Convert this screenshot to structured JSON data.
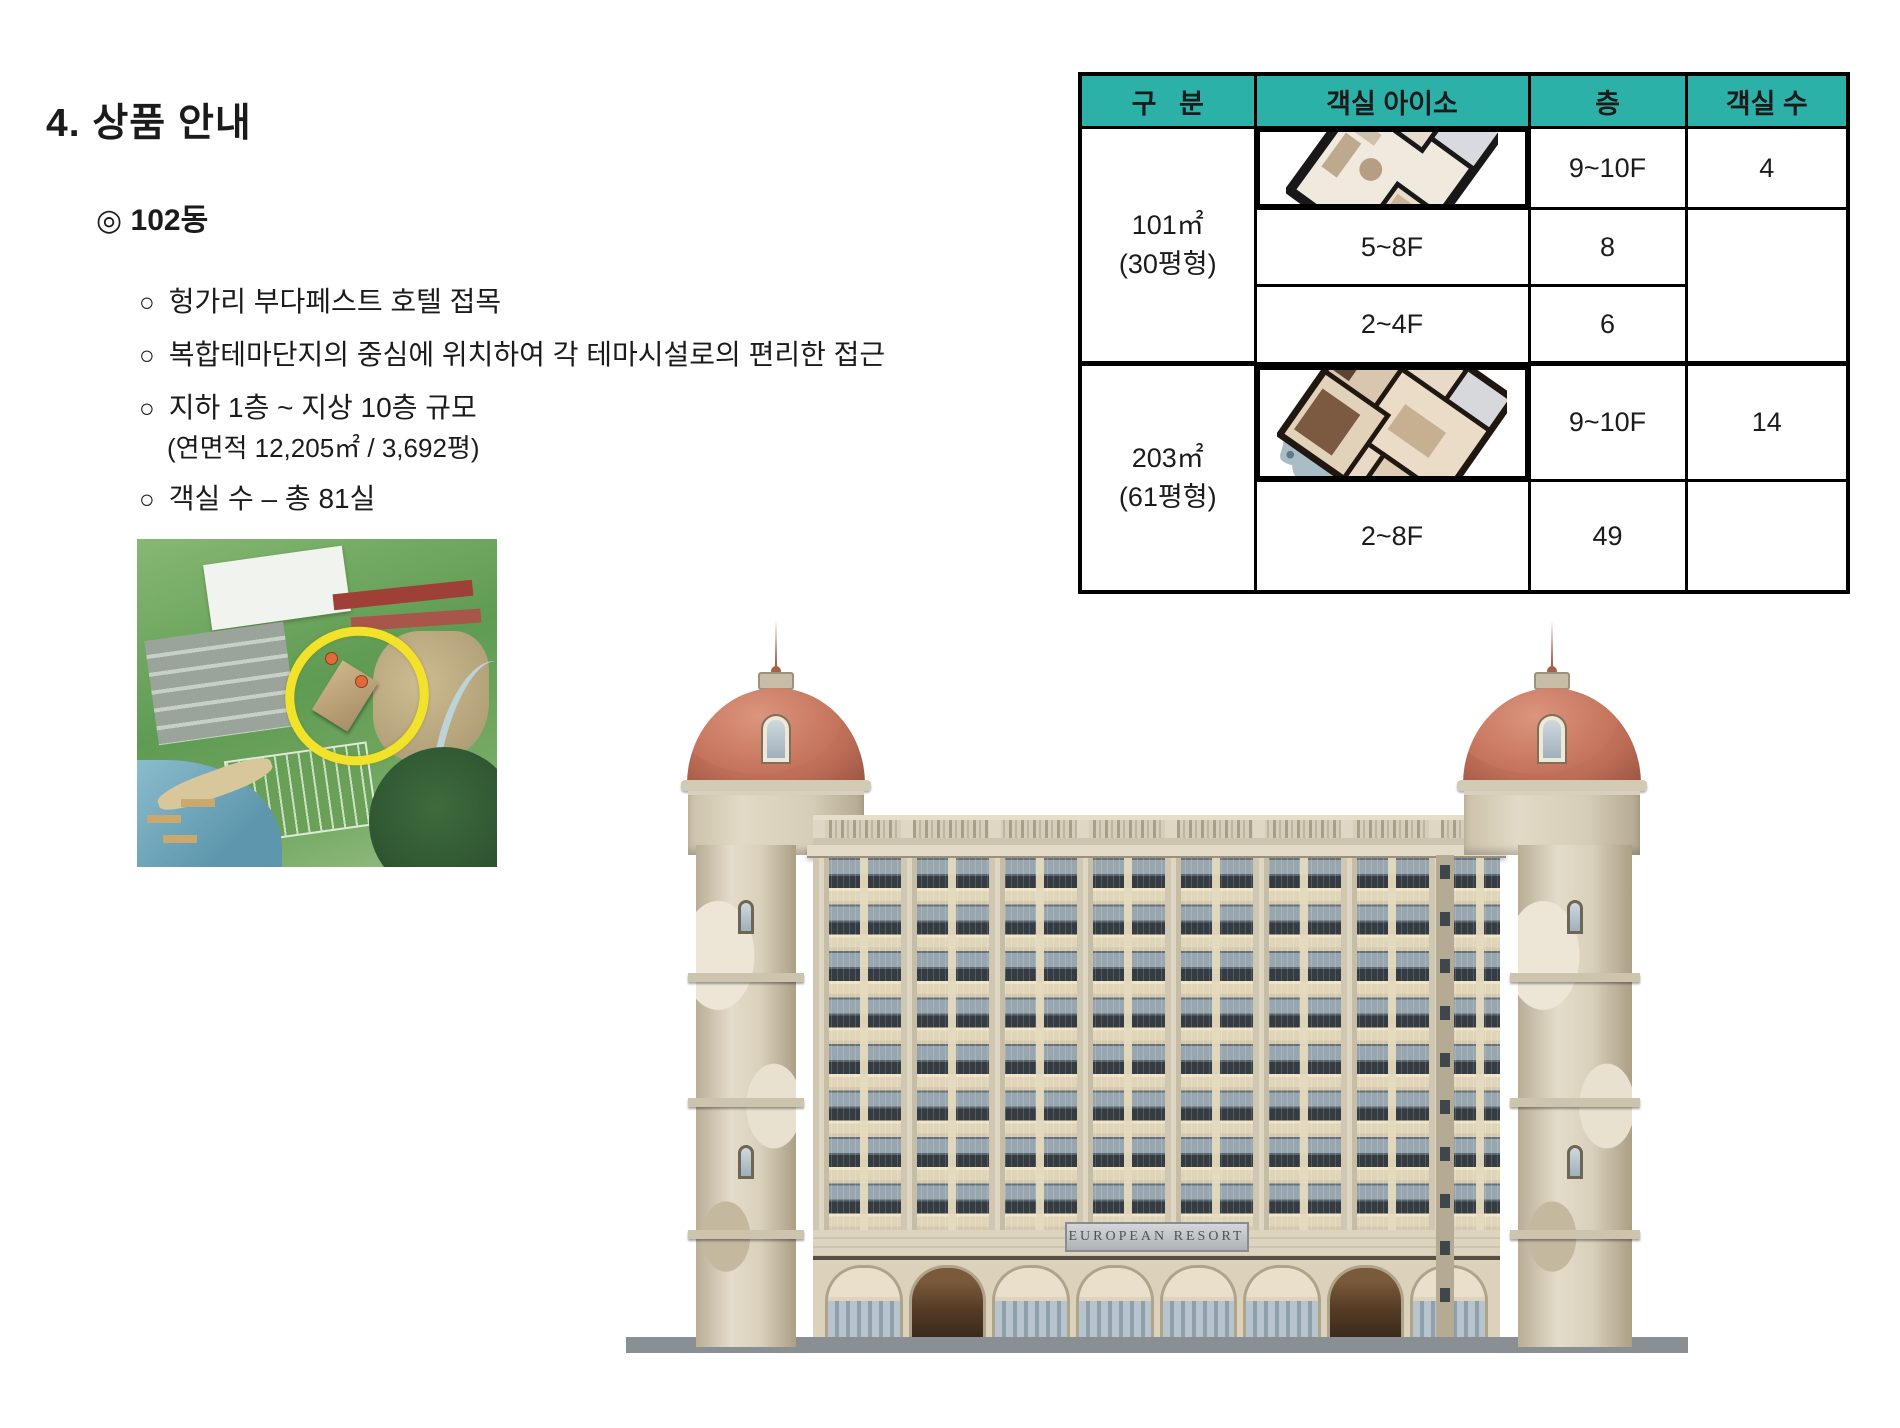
{
  "page": {
    "title": "4. 상품 안내",
    "section": "◎ 102동",
    "bullet_marker": "○",
    "bullets": [
      "헝가리 부다페스트 호텔 접목",
      "복합테마단지의 중심에 위치하여 각 테마시설로의 편리한 접근",
      "지하 1층 ~ 지상 10층 규모",
      "객실 수 – 총 81실"
    ],
    "area_note": "(연면적 12,205㎡ / 3,692평)"
  },
  "table": {
    "headers": [
      "구   분",
      "객실 아이소",
      "층",
      "객실 수"
    ],
    "groups": [
      {
        "size": "101㎡",
        "pyeong": "(30평형)",
        "rows": [
          {
            "floor": "9~10F",
            "count": "4"
          },
          {
            "floor": "5~8F",
            "count": "8"
          },
          {
            "floor": "2~4F",
            "count": "6"
          }
        ]
      },
      {
        "size": "203㎡",
        "pyeong": "(61평형)",
        "rows": [
          {
            "floor": "9~10F",
            "count": "14"
          },
          {
            "floor": "2~8F",
            "count": "49"
          }
        ]
      }
    ]
  },
  "building": {
    "sign": "EUROPEAN  RESORT"
  },
  "colors": {
    "table_header_bg": "#2CB1A9",
    "highlight_yellow": "#F2E32A",
    "dome_terracotta": "#C4725B"
  }
}
